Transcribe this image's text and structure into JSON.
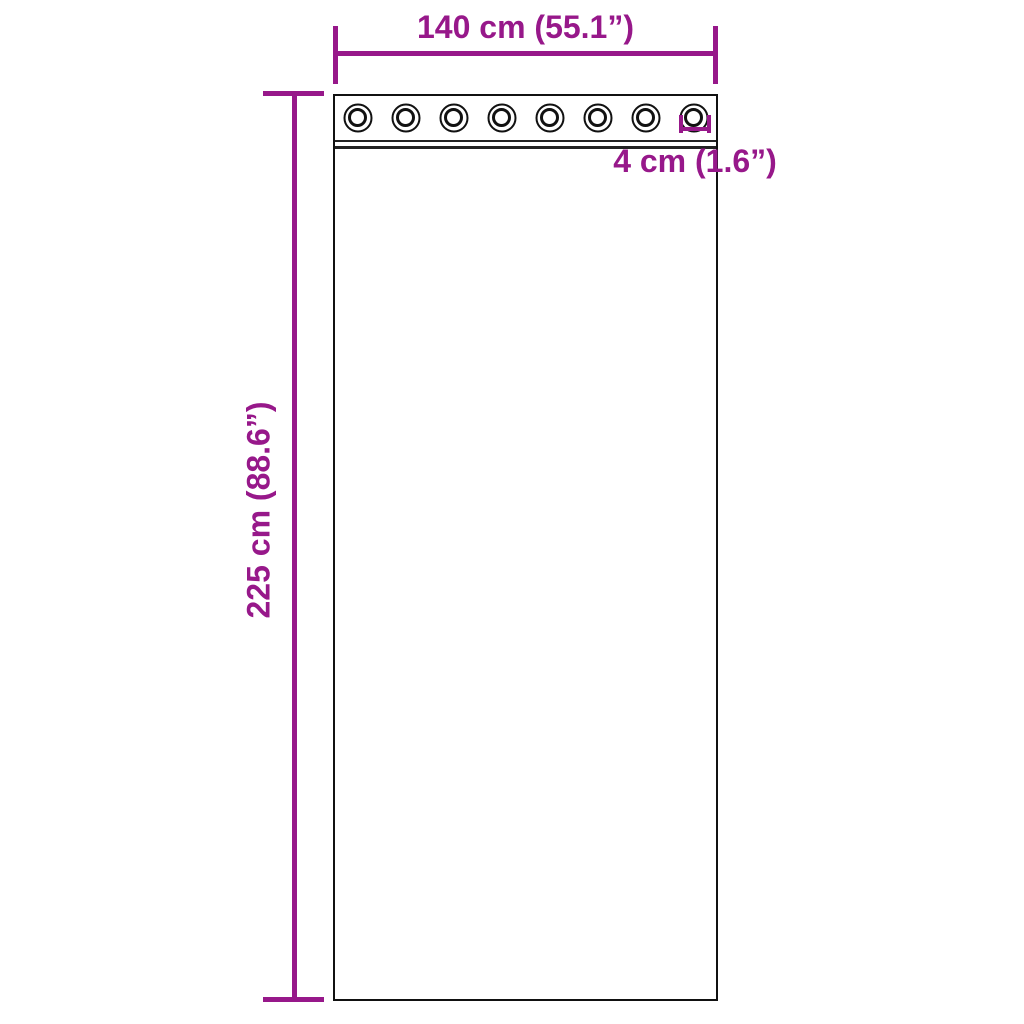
{
  "colors": {
    "accent": "#97188a",
    "outline": "#111111",
    "background": "#ffffff"
  },
  "dimensions": {
    "width": {
      "label": "140 cm (55.1”)"
    },
    "height": {
      "label": "225 cm (88.6”)"
    },
    "grommet": {
      "label": "4 cm (1.6”)"
    }
  },
  "curtain": {
    "grommet_count": 8
  }
}
